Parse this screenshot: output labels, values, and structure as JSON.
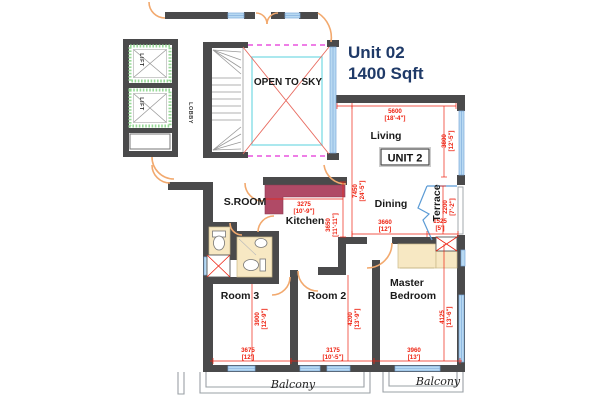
{
  "title": {
    "line1": "Unit 02",
    "line2": "1400 Sqft"
  },
  "unit_box_label": "UNIT 2",
  "rooms": {
    "living": "Living",
    "dining": "Dining",
    "kitchen": "Kitchen",
    "sroom": "S.ROOM",
    "room2": "Room 2",
    "room3": "Room 3",
    "master_line1": "Master",
    "master_line2": "Bedroom",
    "terrace": "Terrace",
    "open_to_sky": "OPEN TO SKY",
    "lobby": "LOBBY",
    "lift_top": "LIFT",
    "lift_bottom": "LIFT",
    "balcony_left": "Balcony",
    "balcony_right": "Balcony"
  },
  "dimensions": {
    "living_width": {
      "mm": "5600",
      "ft": "[18'-4\"]"
    },
    "living_height": {
      "mm": "3800",
      "ft": "[12'-5\"]"
    },
    "unit_depth": {
      "mm": "7450",
      "ft": "[24'-5\"]"
    },
    "dining_width": {
      "mm": "3660",
      "ft": "[12']"
    },
    "terrace_height": {
      "mm": "2200",
      "ft": "[7'-2\"]"
    },
    "terrace_width": {
      "mm": "1525",
      "ft": "[5']"
    },
    "kitchen_width": {
      "mm": "3275",
      "ft": "[10'-9\"]"
    },
    "kitchen_height": {
      "mm": "3650",
      "ft": "[11'-11\"]"
    },
    "room3_height": {
      "mm": "3900",
      "ft": "[12'-9\"]"
    },
    "room3_width": {
      "mm": "3675",
      "ft": "[12']"
    },
    "room2_height": {
      "mm": "4200",
      "ft": "[13'-9\"]"
    },
    "room2_width": {
      "mm": "3175",
      "ft": "[10'-5\"]"
    },
    "master_height": {
      "mm": "4125",
      "ft": "[13'-6\"]"
    },
    "master_width": {
      "mm": "3960",
      "ft": "[13']"
    }
  },
  "colors": {
    "wall": "#4a4a4b",
    "window": "#b8d9f2",
    "door_arc": "#f2a96e",
    "dimension_text": "#ee2211",
    "kitchen_counter": "#b04a66",
    "fixture_fill": "#f7e8c3",
    "lift_hatch": "#98d998",
    "open_sky_border": "#8fe0e8",
    "open_sky_dash": "#ee7ee6",
    "title_text": "#1f3a68"
  }
}
